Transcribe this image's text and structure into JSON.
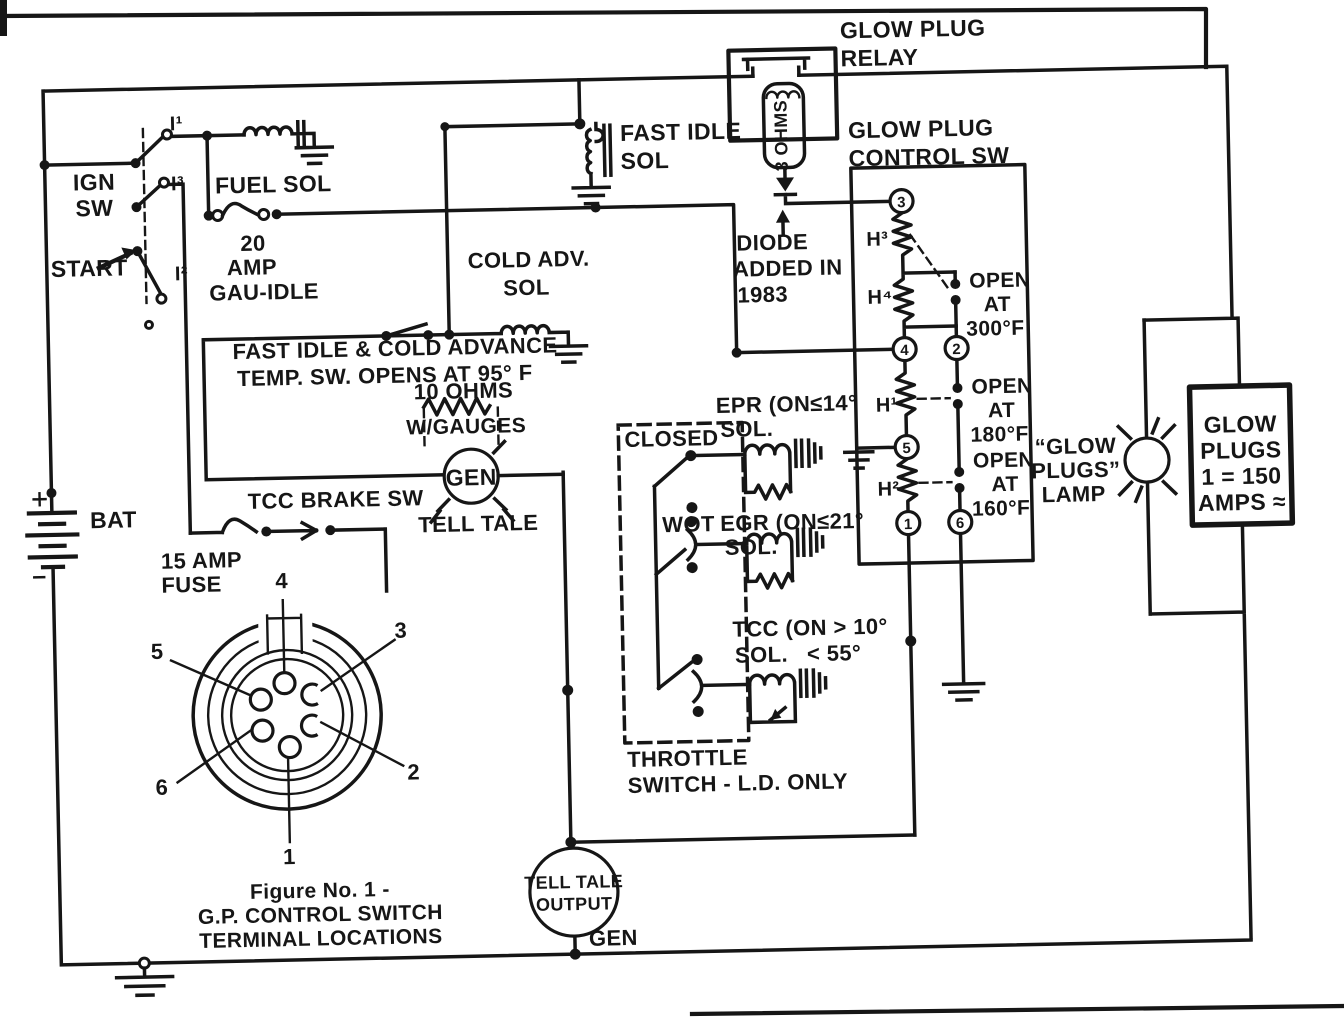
{
  "figure": {
    "caption_1": "Figure No. 1 -",
    "caption_2": "G.P. CONTROL SWITCH",
    "caption_3": "TERMINAL LOCATIONS"
  },
  "labels": {
    "glow_plug_relay_1": "GLOW PLUG",
    "glow_plug_relay_2": "RELAY",
    "gp_control_sw_1": "GLOW PLUG",
    "gp_control_sw_2": "CONTROL SW",
    "fast_idle_sol_1": "FAST IDLE",
    "fast_idle_sol_2": "SOL",
    "ign_sw_1": "IGN",
    "ign_sw_2": "SW",
    "start": "START",
    "sw_i1": "I¹",
    "sw_i3": "I³",
    "sw_i2": "I²",
    "fuel_sol": "FUEL SOL",
    "amp20_1": "20",
    "amp20_2": "AMP",
    "amp20_3": "GAU-IDLE",
    "cold_adv_1": "COLD ADV.",
    "cold_adv_2": "SOL",
    "temp_sw_1": "FAST IDLE & COLD ADVANCE",
    "temp_sw_2": "TEMP. SW. OPENS AT 95° F",
    "ohms10": "10 OHMS",
    "w_gauges": "W/GAUGES",
    "gen": "GEN",
    "tell_tale": "TELL TALE",
    "tcc_brake_sw": "TCC BRAKE SW",
    "bat": "BAT",
    "fuse15_1": "15 AMP",
    "fuse15_2": "FUSE",
    "tto_1": "TELL TALE",
    "tto_2": "OUTPUT",
    "tto_gen": "GEN",
    "closed": "CLOSED",
    "epr_1": "EPR (ON≤14°",
    "epr_2": "SOL.",
    "wot": "WOT",
    "egr_1": "EGR (ON≤21°",
    "egr_2": "SOL.",
    "tcc_1": "TCC (ON > 10°",
    "tcc_2": "SOL.",
    "tcc_3": "< 55°",
    "throttle_1": "THROTTLE",
    "throttle_2": "SWITCH - L.D. ONLY",
    "diode_1": "DIODE",
    "diode_2": " ADDED IN",
    "diode_3": "1983",
    "ohms3": "3 OHMS",
    "h3": "H³",
    "h4": "H⁴",
    "h1": "H¹",
    "h2": "H²",
    "open300_1": "OPEN",
    "open300_2": "AT",
    "open300_3": "300°F",
    "open180_1": "OPEN",
    "open180_2": "AT",
    "open180_3": "180°F",
    "open160_1": "OPEN",
    "open160_2": "AT",
    "open160_3": "160°F",
    "lamp_1": "“GLOW",
    "lamp_2": "PLUGS”",
    "lamp_3": "LAMP",
    "gp_1": "GLOW",
    "gp_2": "PLUGS",
    "gp_3": "1 = 150",
    "gp_4": "AMPS ≈"
  },
  "terminals": {
    "t1": "1",
    "t2": "2",
    "t3": "3",
    "t4": "4",
    "t5": "5",
    "t6": "6"
  },
  "pins": {
    "p1": "1",
    "p2": "2",
    "p3": "3",
    "p4": "4",
    "p5": "5",
    "p6": "6"
  },
  "colors": {
    "ink": "#161616",
    "paper": "#ffffff"
  }
}
